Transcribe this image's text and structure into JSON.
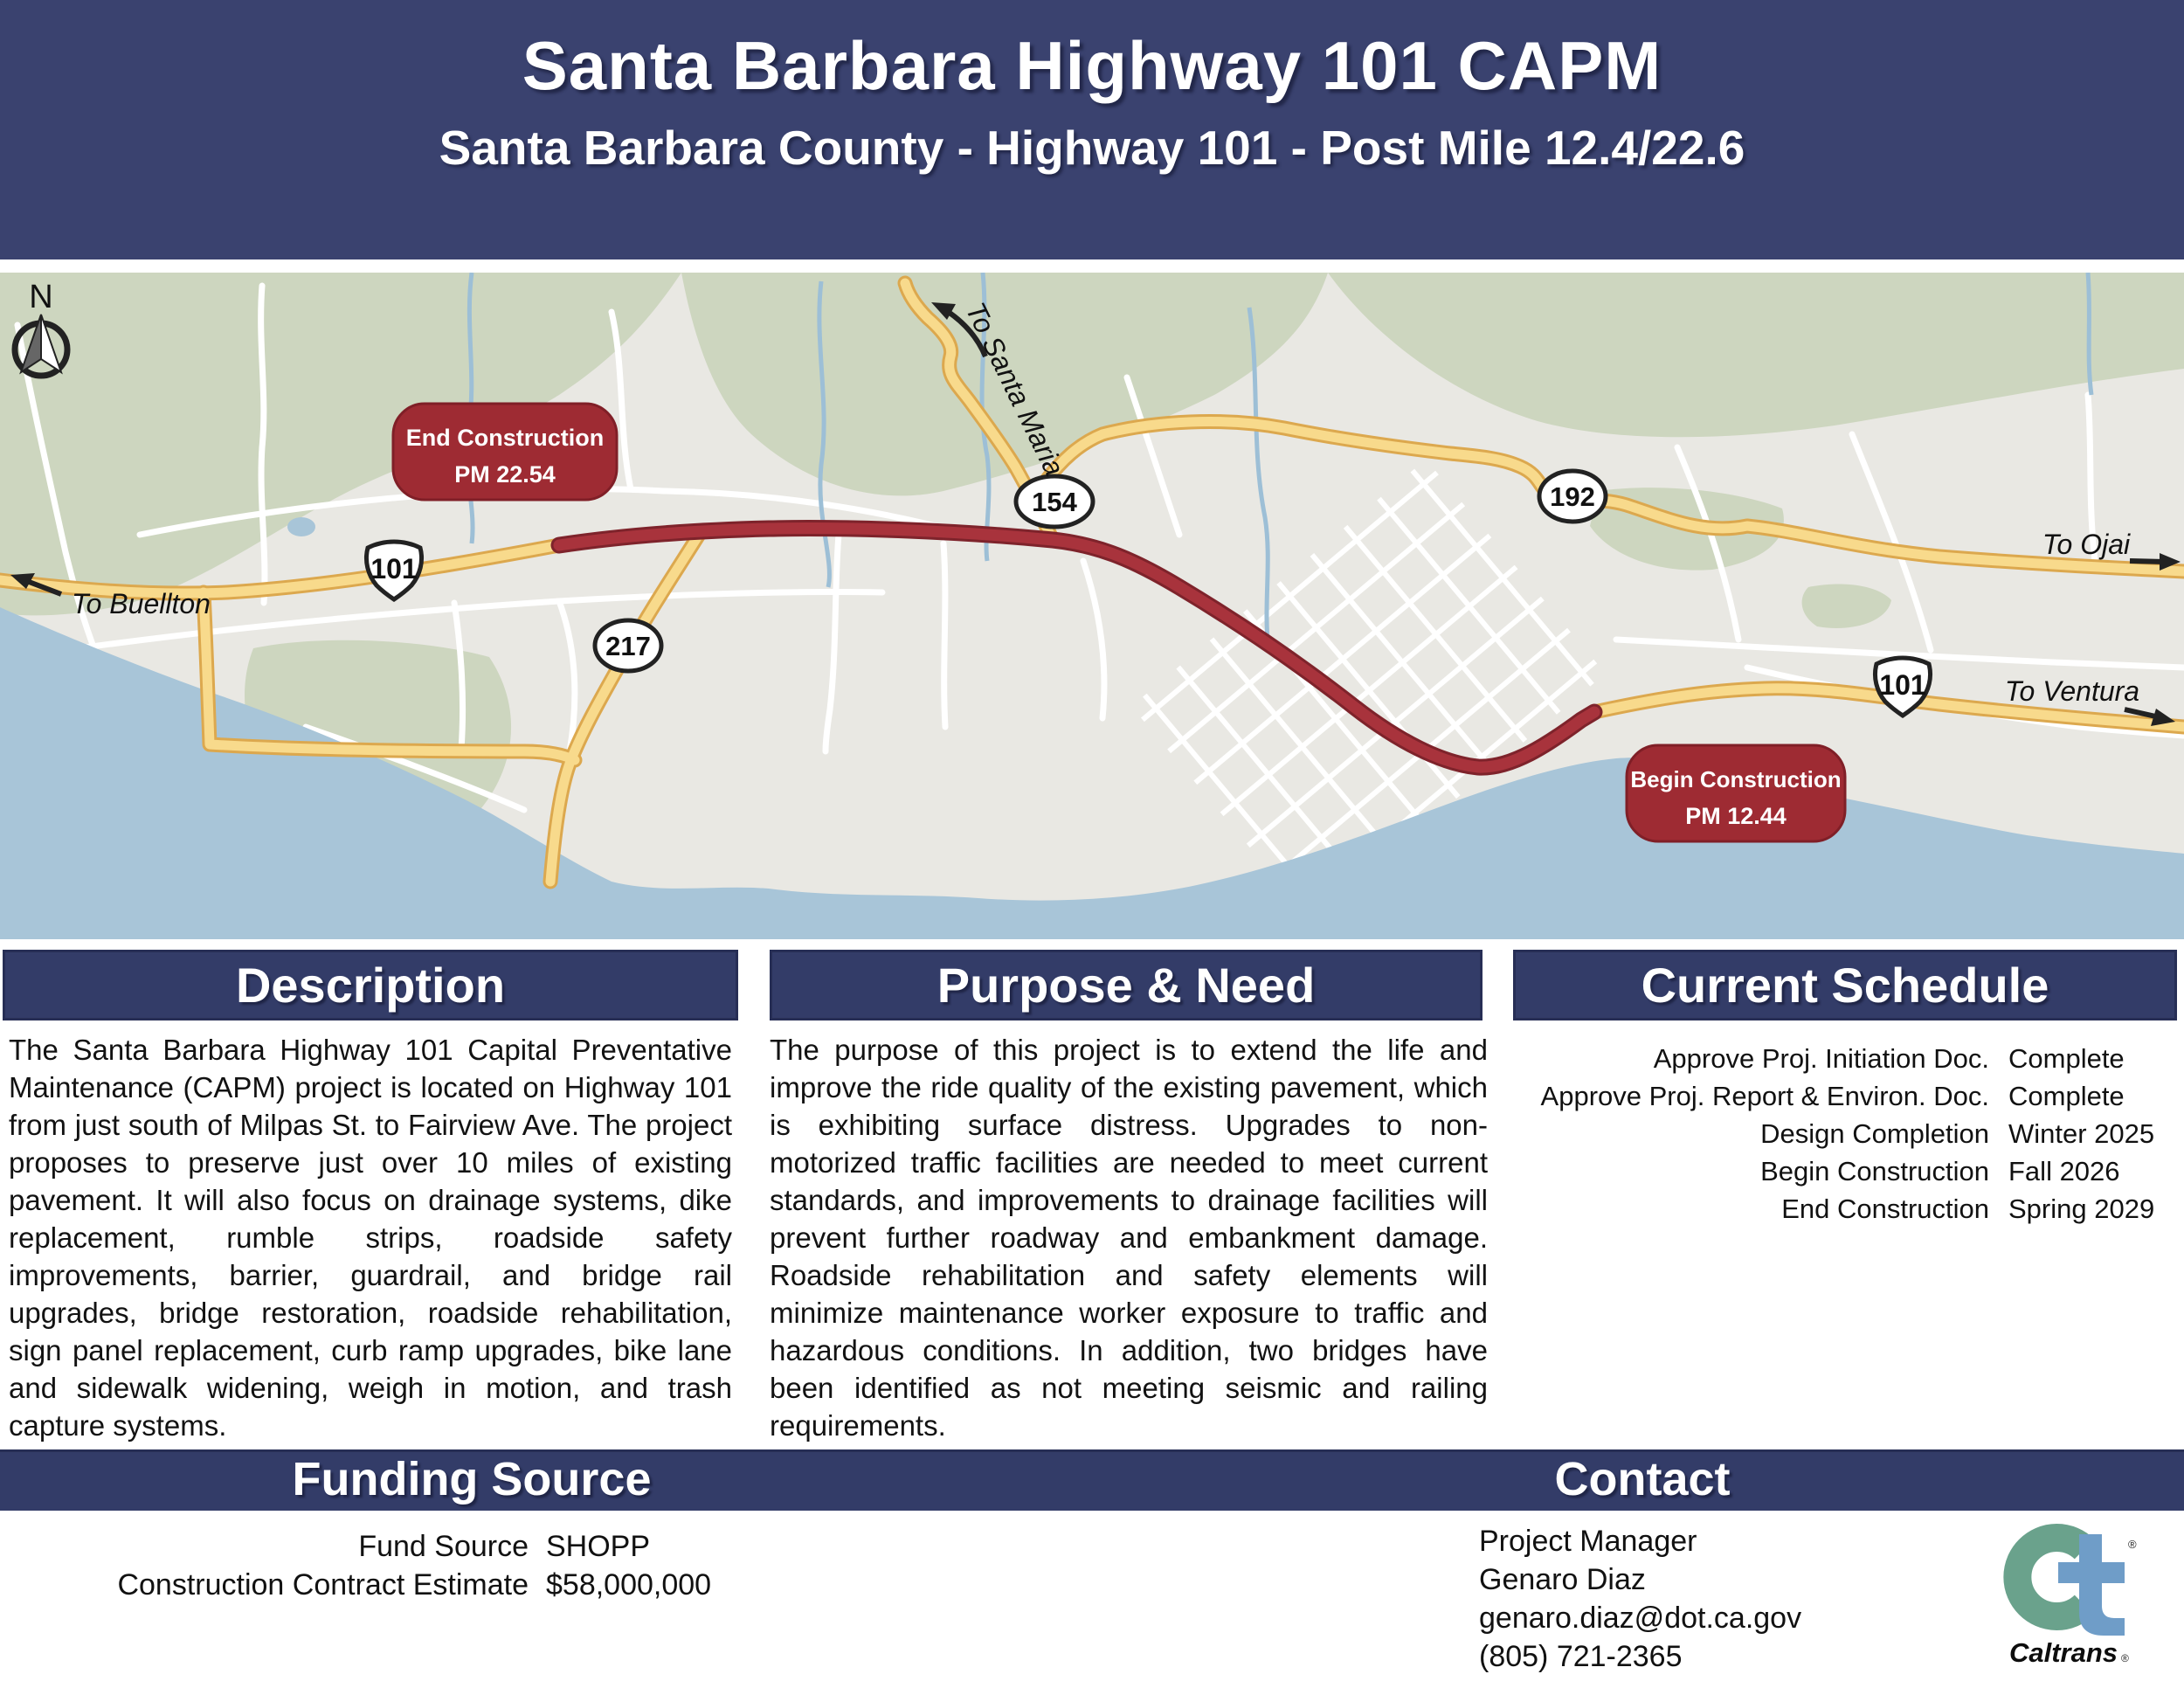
{
  "header": {
    "title": "Santa Barbara Highway 101 CAPM",
    "subtitle": "Santa Barbara County - Highway 101 - Post Mile 12.4/22.6"
  },
  "map": {
    "compass_label": "N",
    "badges": {
      "end": {
        "line1": "End Construction",
        "line2": "PM 22.54"
      },
      "begin": {
        "line1": "Begin Construction",
        "line2": "PM 12.44"
      }
    },
    "shields": {
      "us101_left": "101",
      "us101_right": "101",
      "sr217": "217",
      "sr154": "154",
      "sr192": "192"
    },
    "directions": {
      "buellton": "To Buellton",
      "santa_maria": "To Santa Maria",
      "ojai": "To Ojai",
      "ventura": "To Ventura"
    }
  },
  "sections": {
    "description": {
      "title": "Description",
      "body": "The Santa Barbara Highway 101 Capital Preventative Maintenance (CAPM) project is located on Highway 101 from just south of Milpas St. to Fairview Ave. The project proposes to preserve just over 10 miles of existing pavement. It will also focus on drainage systems, dike replacement, rumble strips, roadside safety improvements, barrier, guardrail, and bridge rail upgrades, bridge restoration, roadside rehabilitation, sign panel replacement, curb ramp upgrades, bike lane and sidewalk widening, weigh in motion, and trash capture systems."
    },
    "purpose": {
      "title": "Purpose & Need",
      "body": "The purpose of this project is to extend the life and improve the ride quality of the existing pavement, which is exhibiting surface distress. Upgrades to non-motorized traffic facilities are needed to meet current standards, and improvements to drainage facilities will prevent further roadway and embankment damage. Roadside rehabilitation and safety elements will minimize maintenance worker exposure to traffic and hazardous conditions. In addition, two bridges have been identified as not meeting seismic and railing requirements."
    },
    "schedule": {
      "title": "Current Schedule",
      "rows": [
        {
          "label": "Approve Proj. Initiation Doc.",
          "value": "Complete"
        },
        {
          "label": "Approve Proj. Report & Environ. Doc.",
          "value": "Complete"
        },
        {
          "label": "Design Completion",
          "value": "Winter 2025"
        },
        {
          "label": "Begin Construction",
          "value": "Fall 2026"
        },
        {
          "label": "End Construction",
          "value": "Spring 2029"
        }
      ]
    }
  },
  "funding": {
    "title": "Funding Source",
    "rows": [
      {
        "label": "Fund Source",
        "value": "SHOPP"
      },
      {
        "label": "Construction Contract Estimate",
        "value": "$58,000,000"
      }
    ]
  },
  "contact": {
    "title": "Contact",
    "lines": [
      "Project Manager",
      "Genaro Diaz",
      "genaro.diaz@dot.ca.gov",
      "(805) 721-2365"
    ]
  },
  "logo": {
    "brand": "Caltrans",
    "registered": "®"
  },
  "colors": {
    "header_navy": "#3a426f",
    "bar_navy": "#333c68",
    "badge_red": "#9e2b33",
    "project_red": "#a8333c",
    "road_yellow": "#f8da8c",
    "road_casing": "#dca84e",
    "water_blue": "#a8c5d8",
    "park_green": "#cdd6bf",
    "land_gray": "#e9e8e3",
    "logo_green": "#6aa28c",
    "logo_blue": "#6f9dc8"
  }
}
